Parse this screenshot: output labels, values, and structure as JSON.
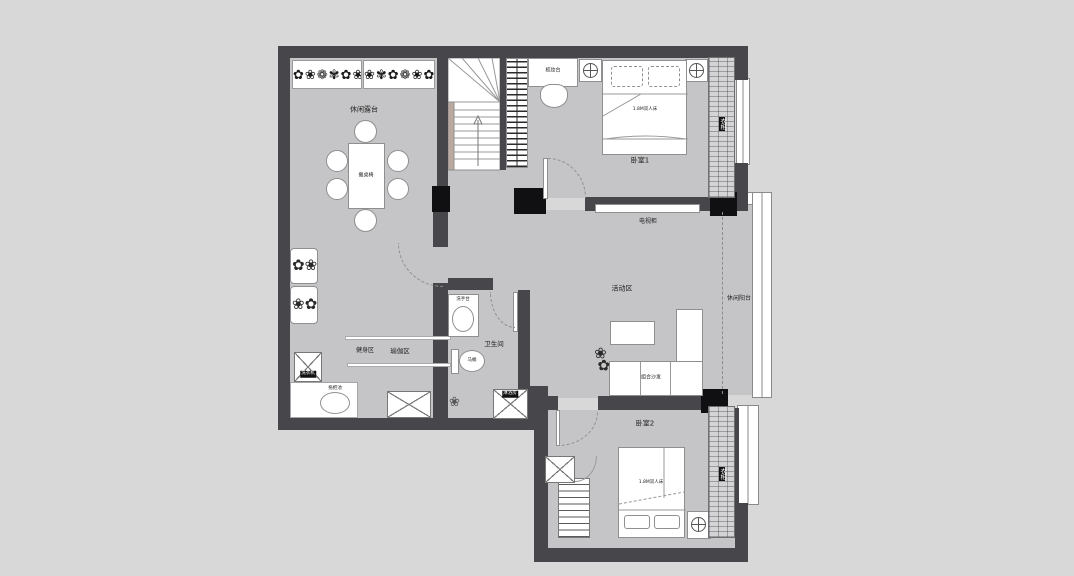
{
  "rooms": {
    "terrace": "休闲露台",
    "bedroom1": "卧室1",
    "activity": "活动区",
    "balcony": "休闲阳台",
    "bathroom": "卫生间",
    "bedroom2": "卧室2"
  },
  "zones": {
    "fitness": "健身区",
    "yoga": "瑜伽区"
  },
  "furniture": {
    "dining_table": "餐桌椅",
    "bed1": "1.8M双人床",
    "bed2": "1.8M双人床",
    "wardrobe1": "衣柜",
    "wardrobe2": "衣柜",
    "desk": "梳妆台",
    "tv_cabinet": "电视柜",
    "sofa": "组合沙发",
    "washer": "洗衣机",
    "mop_pool": "拖把池",
    "basin": "洗手台",
    "toilet": "马桶",
    "shower": "淋浴房"
  },
  "decor": {
    "flower_row_left": "✿❀❁✾✿❀",
    "flower_row_right": "❀✾✿❁❀✿",
    "plant_left_a": "✿❀",
    "plant_left_b": "❀✿",
    "sofa_plant": "❀✿",
    "bath_plant": "❀"
  },
  "colors": {
    "background": "#d8d8d8",
    "wall": "#46464b",
    "floor": "#c5c5c7",
    "furniture": "#ffffff"
  }
}
